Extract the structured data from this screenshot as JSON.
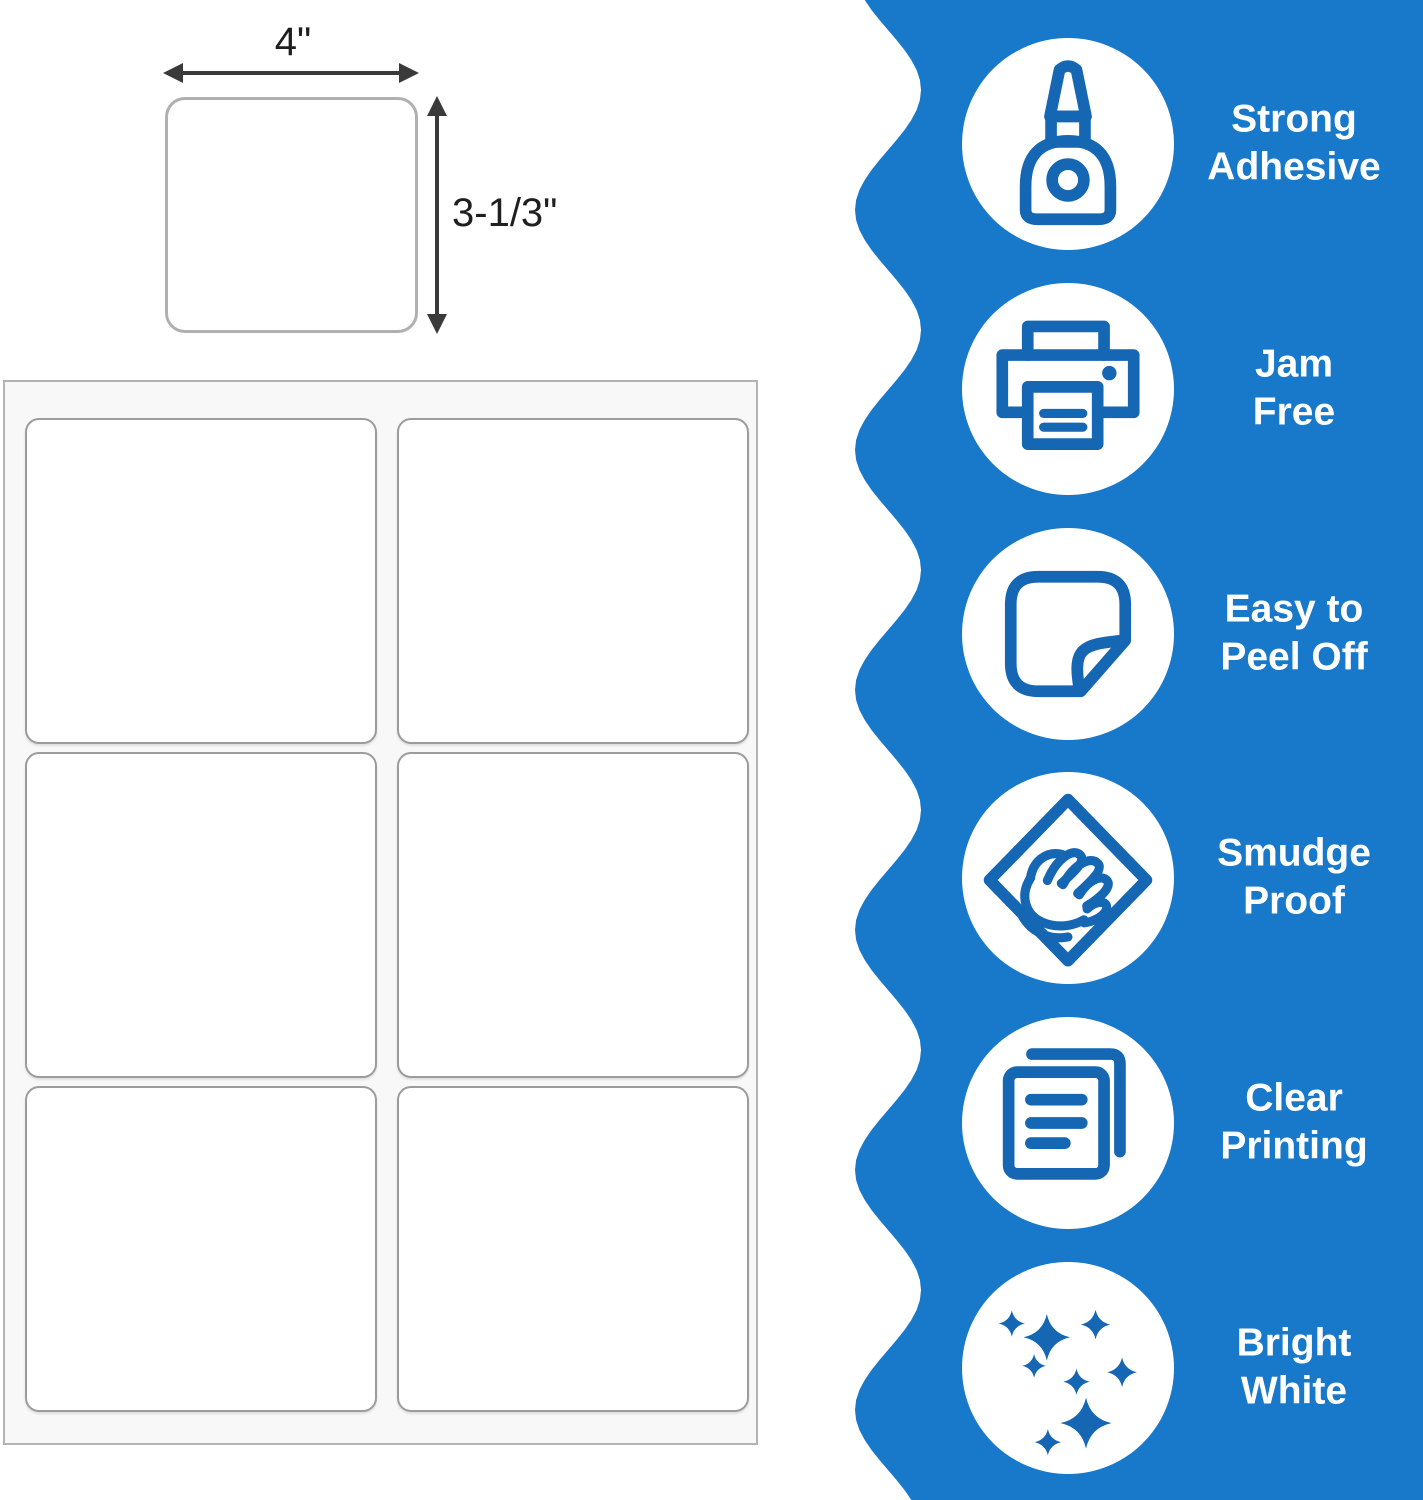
{
  "colors": {
    "panel_blue": "#1878CA",
    "icon_blue": "#1566B3",
    "arrow": "#3a3a3a",
    "sheet_bg": "#f8f8f8",
    "sheet_border": "#b3b3b3",
    "label_border": "#9c9c9c",
    "single_label_border": "#b0b0b0",
    "feature_text": "#ffffff",
    "dimension_text": "#1f1f1f"
  },
  "diagram": {
    "width_label": "4\"",
    "height_label": "3-1/3\""
  },
  "sheet": {
    "columns": 2,
    "rows": 3,
    "labels_per_sheet": 6
  },
  "features": [
    {
      "icon": "glue-bottle-icon",
      "line1": "Strong",
      "line2": "Adhesive"
    },
    {
      "icon": "printer-icon",
      "line1": "Jam",
      "line2": "Free"
    },
    {
      "icon": "peel-sticker-icon",
      "line1": "Easy to",
      "line2": "Peel Off"
    },
    {
      "icon": "smudge-hand-icon",
      "line1": "Smudge",
      "line2": "Proof"
    },
    {
      "icon": "documents-icon",
      "line1": "Clear",
      "line2": "Printing"
    },
    {
      "icon": "sparkles-icon",
      "line1": "Bright",
      "line2": "White"
    }
  ]
}
